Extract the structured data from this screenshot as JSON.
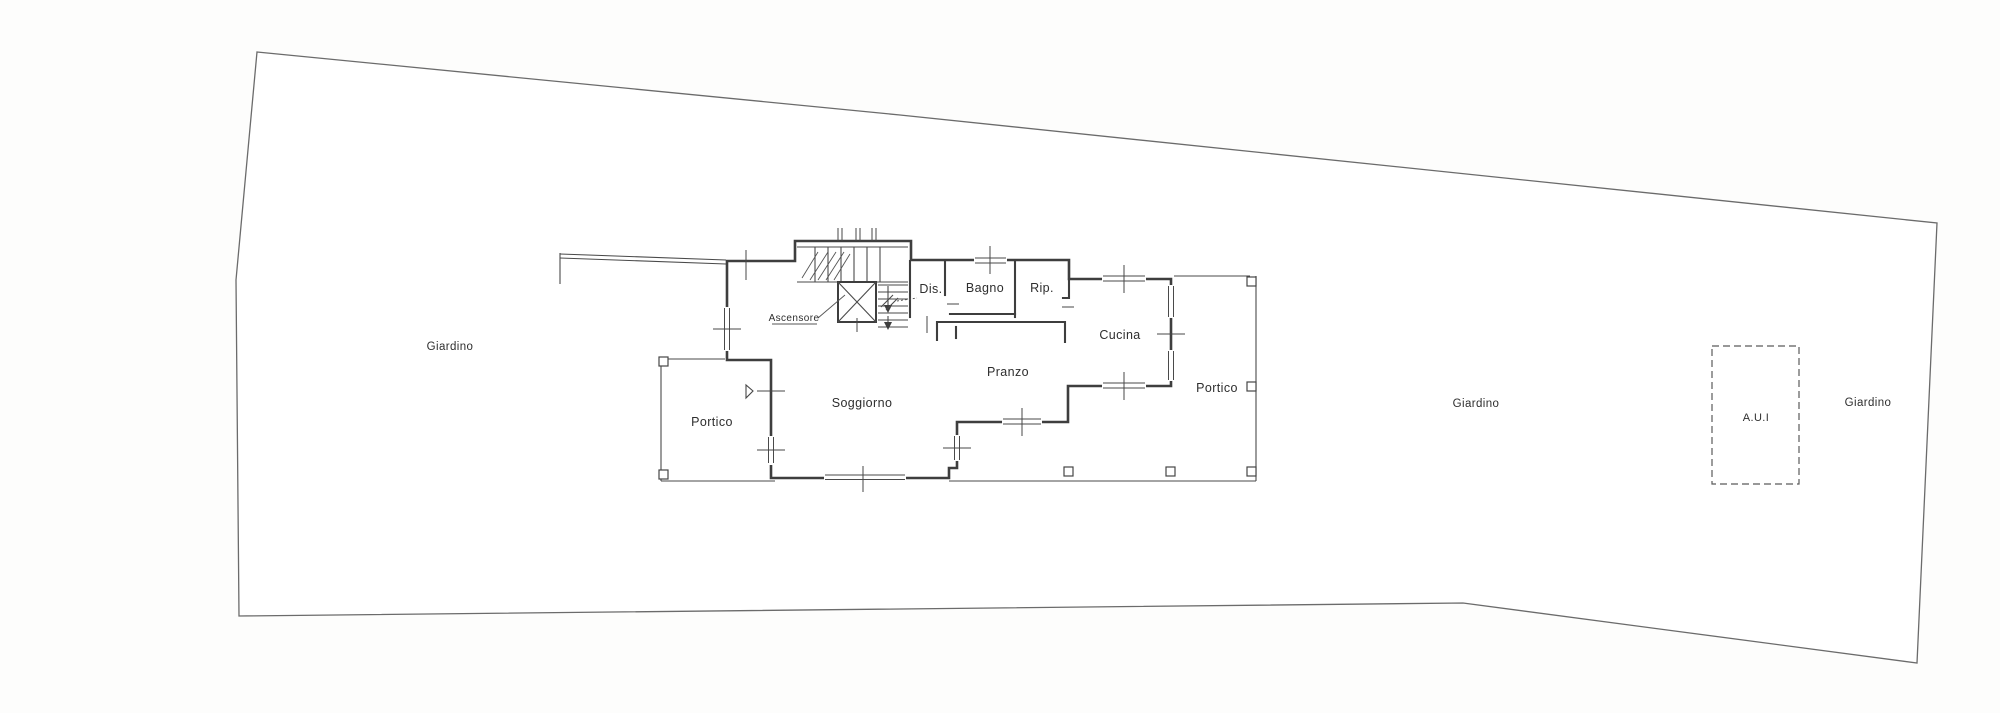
{
  "plan": {
    "type": "architectural floor plan (scanned drawing)",
    "language": "Italian",
    "areas": {
      "garden_left": "Giardino",
      "garden_middle": "Giardino",
      "garden_right": "Giardino",
      "portico_left": "Portico",
      "portico_right": "Portico",
      "annex": "A.U.I"
    },
    "rooms": {
      "living": "Soggiorno",
      "dining": "Pranzo",
      "kitchen": "Cucina",
      "bathroom": "Bagno",
      "hallway": "Dis.",
      "storage": "Rip.",
      "elevator": "Ascensore"
    },
    "colors": {
      "paper": "#fdfdfc",
      "plot_fill": "#ffffff",
      "wall_line": "#3e3e3e",
      "boundary_line": "#6b6b6b",
      "text": "#2e2e2e"
    }
  }
}
